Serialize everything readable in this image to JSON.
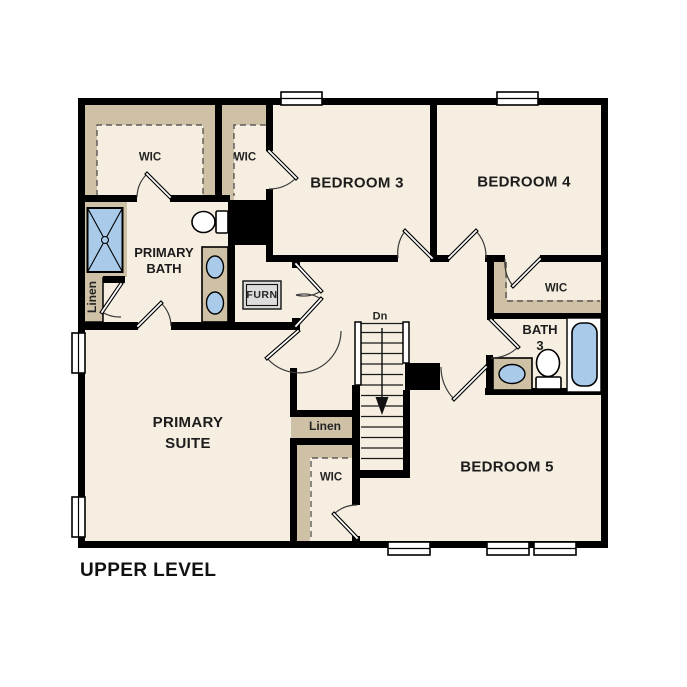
{
  "title": "UPPER LEVEL",
  "colors": {
    "floor": "#f6eee1",
    "shelf_tan": "#cfc1a6",
    "fixture_blue": "#a9cbe9",
    "wall": "#000000",
    "furnace_fill": "#dcdcdc"
  },
  "rooms": {
    "bedroom3": "BEDROOM 3",
    "bedroom4": "BEDROOM 4",
    "bedroom5": "BEDROOM 5",
    "primary_suite": {
      "line1": "PRIMARY",
      "line2": "SUITE"
    },
    "primary_bath": {
      "line1": "PRIMARY",
      "line2": "BATH"
    },
    "bath3": {
      "line1": "BATH",
      "line2": "3"
    },
    "wic_primary": "WIC",
    "wic_bedroom3": "WIC",
    "wic_bedroom4": "WIC",
    "wic_bedroom5": "WIC",
    "linen_upper": "Linen",
    "linen_hall": "Linen",
    "furnace_closet": "FURN"
  },
  "stairs": {
    "direction_label": "Dn"
  },
  "fixtures": [
    "shower",
    "toilet-primary",
    "double-sink-vanity",
    "bathtub",
    "toilet-bath3",
    "single-sink-vanity",
    "furnace"
  ]
}
